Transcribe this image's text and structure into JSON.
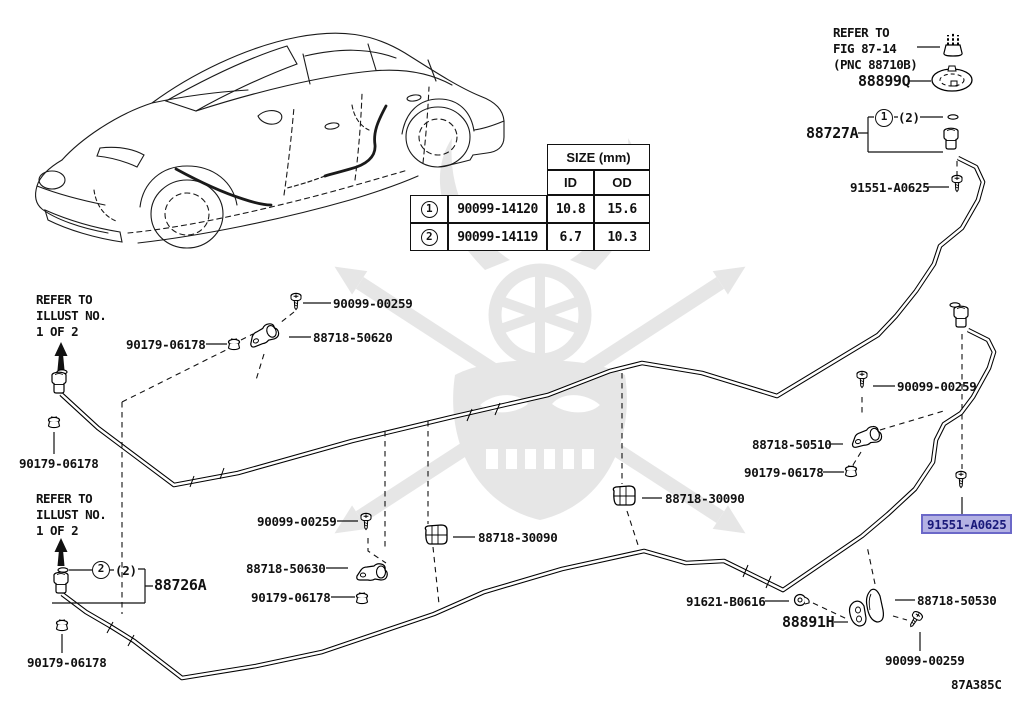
{
  "diagram": {
    "code": "87A385C",
    "highlight": {
      "background": "#b3b1e3",
      "border": "#6b68c8",
      "text": "#19197a"
    }
  },
  "refer_fig": {
    "line1": "REFER TO",
    "line2": "FIG 87-14",
    "line3": "(PNC 88710B)"
  },
  "refer_illust": {
    "line1": "REFER TO",
    "line2": "ILLUST NO.",
    "line3": "1 OF 2"
  },
  "size_table": {
    "title": "SIZE (mm)",
    "col_id": "ID",
    "col_od": "OD",
    "rows": [
      {
        "num": "1",
        "part": "90099-14120",
        "id": "10.8",
        "od": "15.6"
      },
      {
        "num": "2",
        "part": "90099-14119",
        "id": "6.7",
        "od": "10.3"
      }
    ]
  },
  "callouts": {
    "num1": "1",
    "num2": "2",
    "qty2": "(2)"
  },
  "parts": {
    "screw": "90099-00259",
    "grommet": "90179-06178",
    "clamp_50620": "88718-50620",
    "clamp_50510": "88718-50510",
    "clamp_50630": "88718-50630",
    "clip_30090": "88718-30090",
    "clamp_50530": "88718-50530",
    "hose_front": "88727A",
    "hose_rear": "88726A",
    "cap": "88899Q",
    "nozzle": "88891H",
    "screw_a0625": "91551-A0625",
    "clip_b0616": "91621-B0616"
  }
}
